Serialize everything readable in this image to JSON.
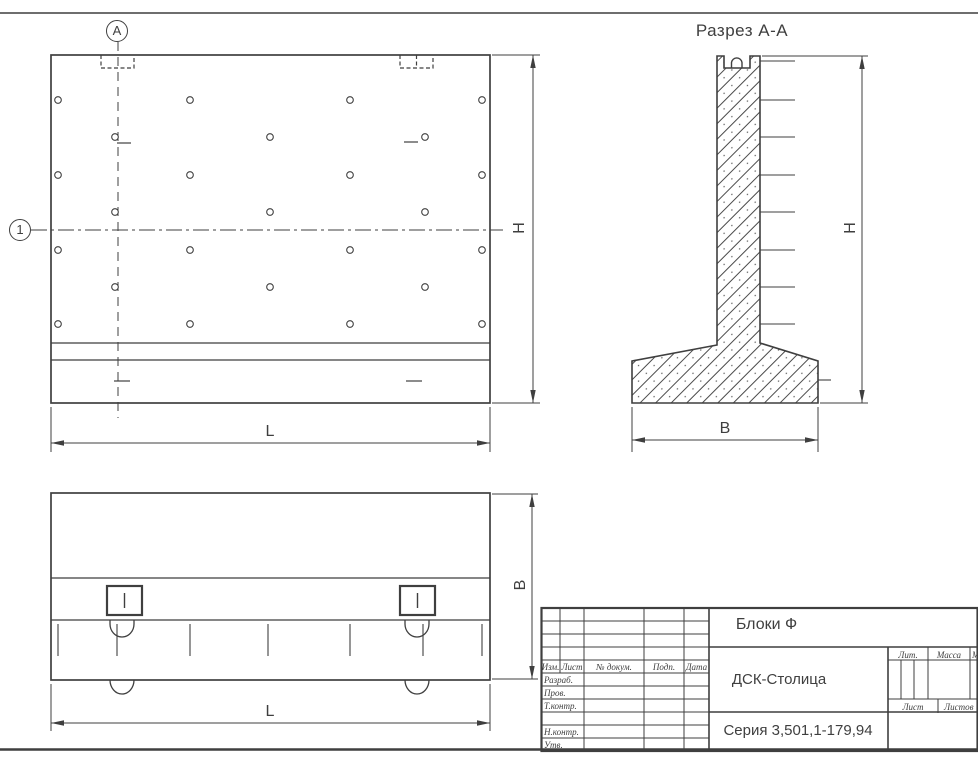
{
  "sheet": {
    "background": "#ffffff",
    "line_color": "#3f3f3f"
  },
  "views": {
    "front": {
      "axis_marker_top": "А",
      "axis_marker_left": "1",
      "dim_width_label": "L",
      "dim_height_label": "H"
    },
    "section": {
      "title": "Разрез А-А",
      "dim_width_label": "B",
      "dim_height_label": "H"
    },
    "plan": {
      "dim_width_label": "L",
      "dim_depth_label": "B"
    }
  },
  "title_block": {
    "product_name": "Блоки Ф",
    "organization": "ДСК-Столица",
    "series": "Серия 3,501,1-179,94",
    "header_cols": [
      "Изм.",
      "Лист",
      "№ докум.",
      "Подп.",
      "Дата"
    ],
    "row_labels": [
      "Разраб.",
      "Пров.",
      "Т.контр.",
      "",
      "Н.контр.",
      "Утв."
    ],
    "lit_label": "Лит.",
    "mass_label": "Масса",
    "scale_label": "Масштаб",
    "sheet_label": "Лист",
    "sheets_label": "Листов"
  }
}
